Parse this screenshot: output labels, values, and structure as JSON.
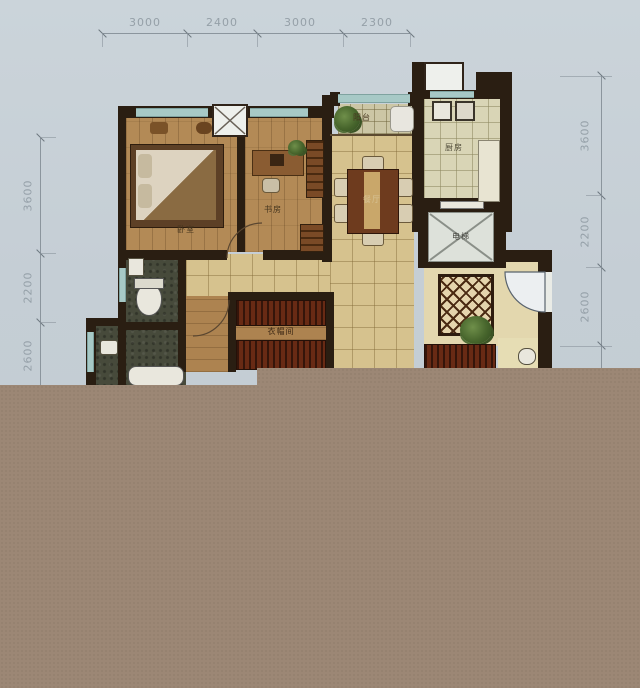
{
  "dimensions": {
    "top": [
      "3000",
      "2400",
      "3000",
      "2300"
    ],
    "left": [
      "3600",
      "2200",
      "2600"
    ],
    "right": [
      "3600",
      "2200",
      "2600"
    ]
  },
  "rooms": {
    "bedroom": "卧室",
    "study": "书房",
    "dining": "餐厅",
    "balcony": "阳台",
    "kitchen": "厨房",
    "elevator": "电梯",
    "cloakroom": "衣帽间"
  },
  "colors": {
    "background": "#c5ced5",
    "wall": "#2a1e12",
    "wood_floor": "#b38a56",
    "living_tile": "#d6c28e",
    "kitchen_tile": "#d9d5b6",
    "bath_floor": "#474a3b",
    "window_glass": "#a7c9c6",
    "wardrobe": "#682a14",
    "censor_overlay": "#9c8775",
    "dimension_text": "#95a0a8"
  }
}
